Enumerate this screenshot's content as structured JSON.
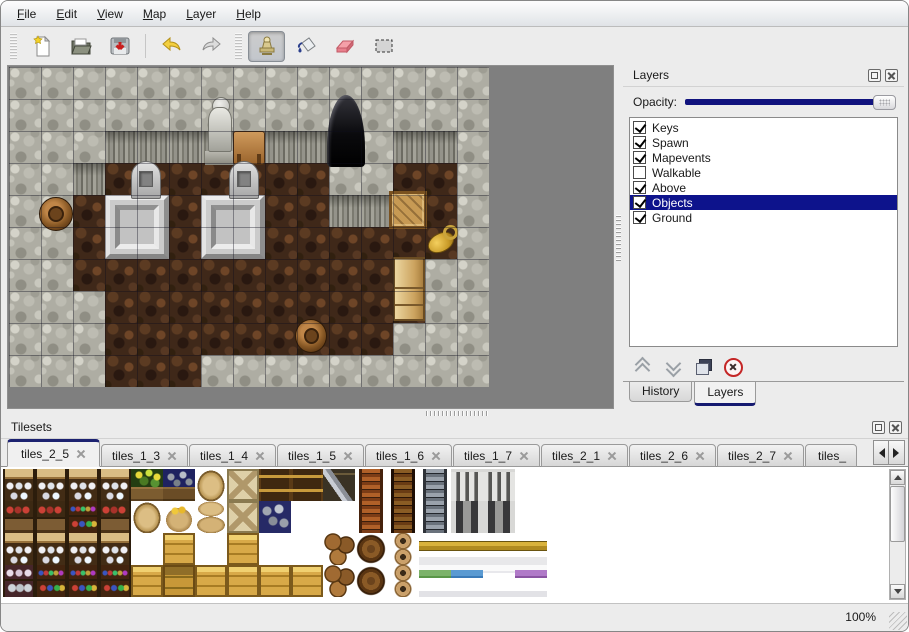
{
  "menu": {
    "items": [
      "File",
      "Edit",
      "View",
      "Map",
      "Layer",
      "Help"
    ]
  },
  "toolbar": {
    "buttons": [
      {
        "name": "new-map",
        "icon": "new-file-icon",
        "prefix": "handle"
      },
      {
        "name": "open-map",
        "icon": "open-folder-icon"
      },
      {
        "name": "save-map",
        "icon": "save-icon"
      },
      {
        "name": "undo",
        "icon": "undo-icon",
        "prefix": "separator"
      },
      {
        "name": "redo",
        "icon": "redo-icon"
      },
      {
        "name": "stamp-tool",
        "icon": "stamp-tool-icon",
        "prefix": "handle",
        "active": true
      },
      {
        "name": "fill-tool",
        "icon": "fill-bucket-icon"
      },
      {
        "name": "eraser-tool",
        "icon": "eraser-icon"
      },
      {
        "name": "select-tool",
        "icon": "rect-select-icon"
      }
    ]
  },
  "map": {
    "tile_size": 32,
    "grid": [
      "WWWWWWWWWWWWWWW",
      "WWWWWWWWWWWWWWW",
      "WWWWWWWWWWWWWWW",
      "WWWFFFFFFFWWFFW",
      "WWFFFFFFFFWWFFW",
      "WWFFFFFFFFFFFFW",
      "WWFFFFFFFFFFFWW",
      "WWWFFFFFFFFFFWW",
      "WWWFFFFFFFFFWWW",
      "WWWFFFWWWWWWWWW"
    ],
    "objects": [
      {
        "name": "statue",
        "type": "statue",
        "x": 196,
        "y": 30,
        "w": 30,
        "h": 68
      },
      {
        "name": "table",
        "type": "table",
        "x": 224,
        "y": 64,
        "w": 32,
        "h": 34
      },
      {
        "name": "cave-entrance",
        "type": "cave",
        "x": 318,
        "y": 28,
        "w": 38,
        "h": 72
      },
      {
        "name": "pedestal-left",
        "type": "pedestal",
        "x": 96,
        "y": 128,
        "w": 64,
        "h": 64
      },
      {
        "name": "pedestal-right",
        "type": "pedestal",
        "x": 192,
        "y": 128,
        "w": 64,
        "h": 64
      },
      {
        "name": "gravestone-left",
        "type": "grave",
        "x": 122,
        "y": 94,
        "w": 30,
        "h": 38
      },
      {
        "name": "gravestone-right",
        "type": "grave",
        "x": 220,
        "y": 94,
        "w": 30,
        "h": 38
      },
      {
        "name": "barrel-left",
        "type": "barrel",
        "x": 30,
        "y": 130,
        "w": 34,
        "h": 34
      },
      {
        "name": "tool-crate",
        "type": "crate",
        "x": 380,
        "y": 124,
        "w": 38,
        "h": 38
      },
      {
        "name": "golden-jug",
        "type": "jug",
        "x": 416,
        "y": 156,
        "w": 36,
        "h": 36
      },
      {
        "name": "cabinet",
        "type": "cabinet",
        "x": 384,
        "y": 190,
        "w": 32,
        "h": 64
      },
      {
        "name": "barrel-bottom",
        "type": "barrel",
        "x": 286,
        "y": 252,
        "w": 32,
        "h": 34
      }
    ]
  },
  "layers_panel": {
    "title": "Layers",
    "opacity_label": "Opacity:",
    "layers": [
      {
        "label": "Keys",
        "checked": true,
        "selected": false
      },
      {
        "label": "Spawn",
        "checked": true,
        "selected": false
      },
      {
        "label": "Mapevents",
        "checked": true,
        "selected": false
      },
      {
        "label": "Walkable",
        "checked": false,
        "selected": false
      },
      {
        "label": "Above",
        "checked": true,
        "selected": false
      },
      {
        "label": "Objects",
        "checked": true,
        "selected": true
      },
      {
        "label": "Ground",
        "checked": true,
        "selected": false
      }
    ],
    "buttons": [
      "raise-layer",
      "lower-layer",
      "duplicate-layer",
      "delete-layer"
    ],
    "tabs": [
      {
        "label": "History",
        "active": false
      },
      {
        "label": "Layers",
        "active": true
      }
    ]
  },
  "tilesets_panel": {
    "title": "Tilesets",
    "tabs": [
      {
        "label": "tiles_2_5",
        "active": true
      },
      {
        "label": "tiles_1_3",
        "active": false
      },
      {
        "label": "tiles_1_4",
        "active": false
      },
      {
        "label": "tiles_1_5",
        "active": false
      },
      {
        "label": "tiles_1_6",
        "active": false
      },
      {
        "label": "tiles_1_7",
        "active": false
      },
      {
        "label": "tiles_2_1",
        "active": false
      },
      {
        "label": "tiles_2_6",
        "active": false
      },
      {
        "label": "tiles_2_7",
        "active": false
      },
      {
        "label": "tiles_",
        "active": false,
        "partial": true
      }
    ],
    "tiles": [
      [
        "s1",
        "s1",
        "s1",
        "s1",
        "pl",
        "ob",
        "sk",
        "cx",
        "ct",
        "ct",
        "cz",
        "lr",
        "ld",
        "lg",
        "ar",
        "ar",
        "w0"
      ],
      [
        "s2",
        "s2",
        "s3",
        "s2",
        "sk",
        "sg",
        "ss",
        "cx",
        "or",
        "w0",
        "w0",
        "lr",
        "ld",
        "lg",
        "dw",
        "dw",
        "w0"
      ],
      [
        "s1",
        "s1",
        "s1",
        "s1",
        "w0",
        "cr",
        "w0",
        "cr",
        "w0",
        "w0",
        "bp",
        "bl",
        "po",
        "bh",
        "bh",
        "bh",
        "bh"
      ],
      [
        "s4",
        "s3",
        "s3",
        "s3",
        "cr",
        "cf",
        "cr",
        "cr",
        "cr",
        "cr",
        "bp",
        "bl",
        "po",
        "bg",
        "bb",
        "bw",
        "bu"
      ]
    ]
  },
  "status_bar": {
    "zoom_level": "100%"
  },
  "colors": {
    "highlight": "#0d138c",
    "window_bg": "#ececec",
    "map_view_bg": "#7f7f7f"
  }
}
